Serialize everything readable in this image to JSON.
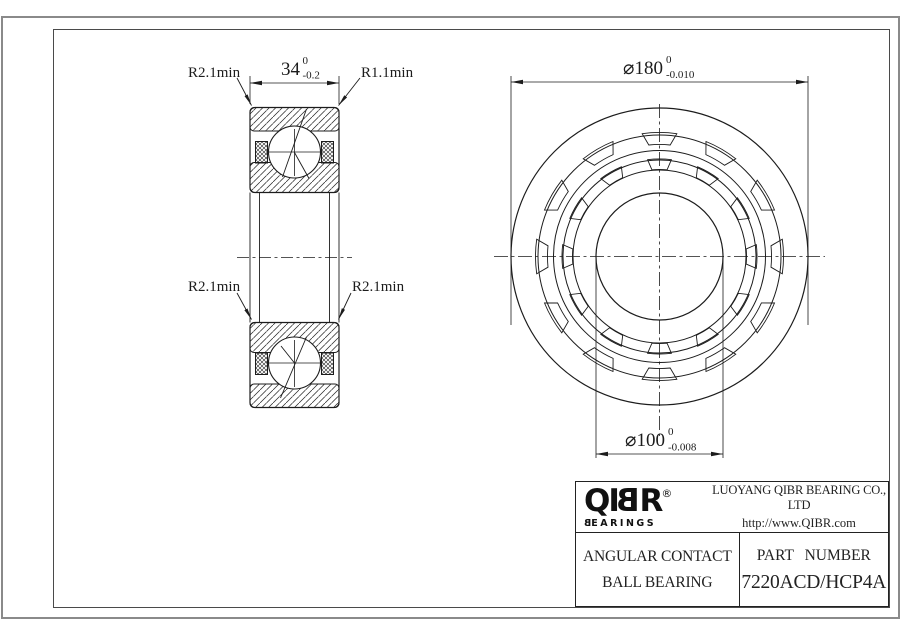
{
  "section_view": {
    "dim_width": {
      "value": "34",
      "tol_upper": "0",
      "tol_lower": "-0.2"
    },
    "labels": {
      "top_left": "R2.1min",
      "top_right": "R1.1min",
      "mid_left": "R2.1min",
      "mid_right": "R2.1min"
    }
  },
  "front_view": {
    "dim_outer": {
      "value": "⌀180",
      "tol_upper": "0",
      "tol_lower": "-0.010"
    },
    "dim_bore": {
      "value": "⌀100",
      "tol_upper": "0",
      "tol_lower": "-0.008"
    }
  },
  "title_block": {
    "logo": {
      "l1": "Q",
      "l2": "I",
      "l3": "B",
      "l4": "R",
      "registered": "®",
      "subtitle_first": "B",
      "subtitle_rest": "EARINGS"
    },
    "company": {
      "name": "LUOYANG QIBR BEARING CO., LTD",
      "url": "http://www.QIBR.com"
    },
    "product": {
      "line1": "ANGULAR CONTACT",
      "line2": "BALL BEARING"
    },
    "part": {
      "label": "PART NUMBER",
      "number": "7220ACD/HCP4A"
    }
  },
  "colors": {
    "line": "#1c1c1c",
    "frame_outer": "#8a8a8a",
    "frame_inner": "#4a4a4a",
    "background": "#ffffff"
  }
}
